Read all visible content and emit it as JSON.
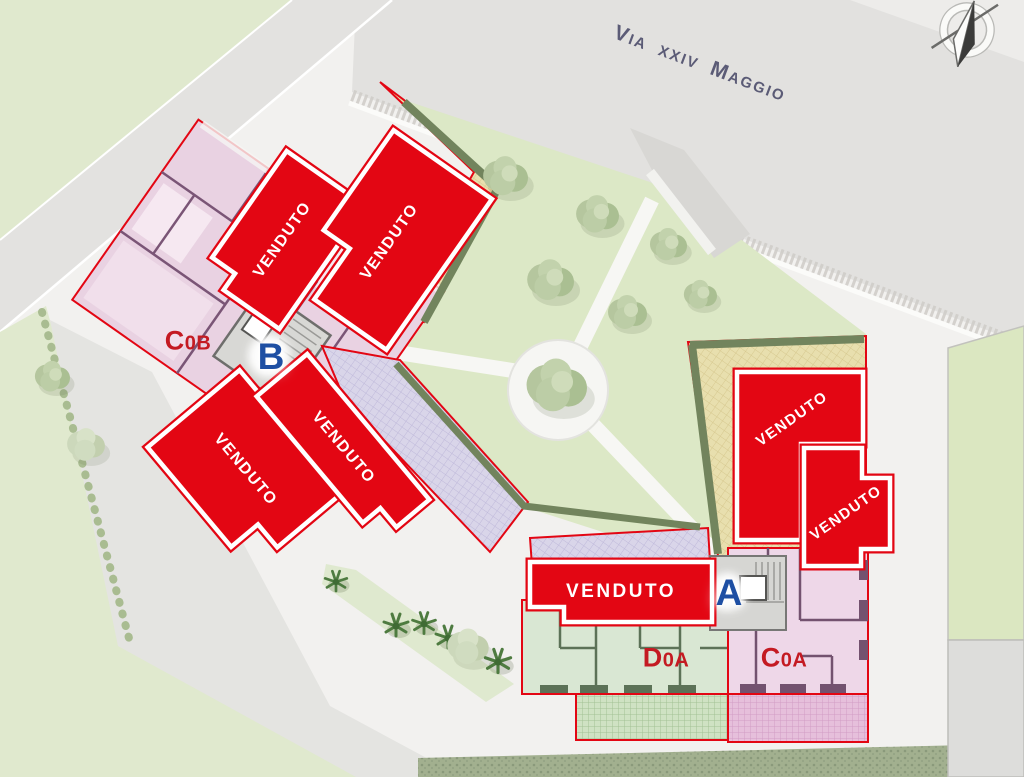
{
  "street": {
    "name": "Via xxiv Maggio"
  },
  "compass": {
    "icon": "north-compass"
  },
  "sold_units": [
    {
      "id": "nw-upper-left",
      "label": "VENDUTO"
    },
    {
      "id": "nw-upper-right",
      "label": "VENDUTO"
    },
    {
      "id": "sw-lower-left",
      "label": "VENDUTO"
    },
    {
      "id": "sw-upper-right",
      "label": "VENDUTO"
    },
    {
      "id": "east-upper",
      "label": "VENDUTO"
    },
    {
      "id": "east-lower",
      "label": "VENDUTO"
    },
    {
      "id": "south-center",
      "label": "VENDUTO"
    }
  ],
  "available_units": [
    {
      "id": "C0B",
      "initial": "C",
      "rest": "0B"
    },
    {
      "id": "D0A",
      "initial": "D",
      "rest": "0A"
    },
    {
      "id": "C0A",
      "initial": "C",
      "rest": "0A"
    }
  ],
  "stairwells": [
    {
      "id": "B",
      "label": "B"
    },
    {
      "id": "A",
      "label": "A"
    }
  ],
  "colors": {
    "sold-red": "#e30613",
    "unit-label-red": "#c41a22",
    "entrance-blue": "#1e4fa3",
    "street-text": "#5b5b76"
  }
}
